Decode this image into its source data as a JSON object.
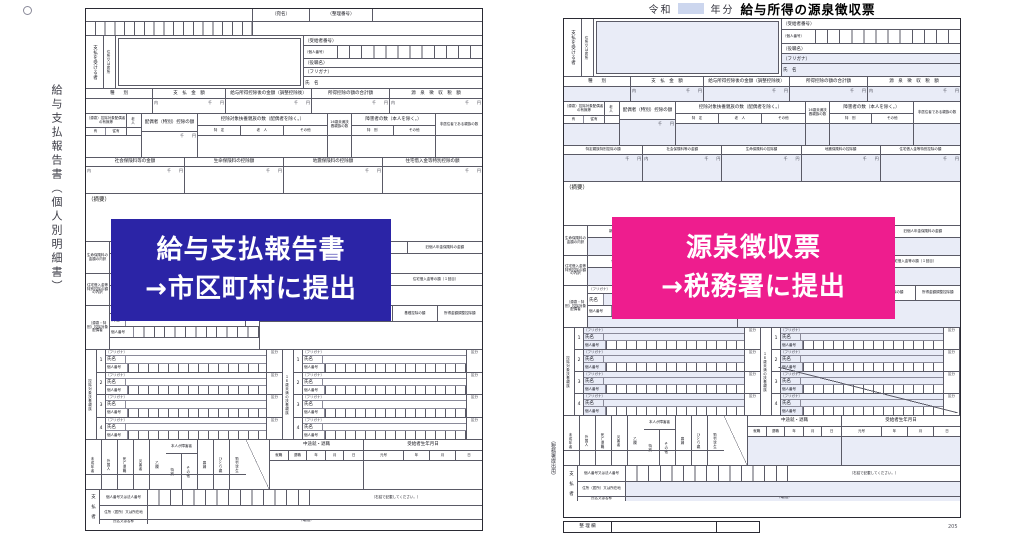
{
  "overlays": {
    "blue": {
      "color": "#2b24a6",
      "line1": "給与支払報告書",
      "line2": "→市区町村に提出"
    },
    "pink": {
      "color": "#ee1d8e",
      "line1": "源泉徴収票",
      "line2": "→税務署に提出"
    }
  },
  "left": {
    "vertical_title": "給与支払報告書（個人別明細書）",
    "top_labels": {
      "c1": "（宛名）",
      "c2": "（整理番号）"
    }
  },
  "right": {
    "title_era": "令和",
    "title_year_suffix": "年分",
    "title_main": "給与所得の源泉徴収票",
    "margin_note": "（税務署提出用）",
    "seiri_label": "整 理 欄",
    "page_no": "205",
    "rowD_cells": [
      "特定親族特別控除の額",
      "社会保険料等の金額",
      "生命保険料の控除額",
      "地震保険料の控除額",
      "住宅借入金等特別控除の額"
    ]
  },
  "common": {
    "recipient": {
      "payer_receiver": "支払を受ける者",
      "address": "住所又は居所",
      "recipient_no": "（受給者番号）",
      "personal_no": "（個人番号）",
      "role": "（役職名）",
      "furigana": "（フリガナ）",
      "name": "氏　名"
    },
    "amounts": {
      "headers": [
        "種　　別",
        "支　払　金　額",
        "給与所得控除後の金額（調整控除後）",
        "所得控除の額の合計額",
        "源　泉　徴　収　税　額"
      ],
      "uchi": "内",
      "senyen": "千　　円"
    },
    "rowC": {
      "spouse": "（源泉）控除対象配偶者の有無等",
      "rojin": "老人",
      "ari": "有",
      "juari": "従有",
      "spouse_ded": "配偶者（特別）控除の額",
      "dep": "控除対象扶養親族の数（配偶者を除く。）",
      "depcols": [
        "特　定",
        "老　人",
        "その他"
      ],
      "u16": "16歳未満扶養親族の数",
      "disabled": "障害者の数（本人を除く。）",
      "discols": [
        "特　別",
        "その他"
      ],
      "nonres": "非居住者である親族の数"
    },
    "rowD": {
      "cells": [
        "社会保険料等の金額",
        "生命保険料の控除額",
        "地震保険料の控除額",
        "住宅借入金等特別控除の額"
      ]
    },
    "tekiyo": "（摘要）",
    "ins": {
      "label": "生命保険料の金額の内訳",
      "cells": [
        "新生命保険料の金額",
        "旧生命保険料の金額",
        "介護医療保険料の金額",
        "新個人年金保険料の金額",
        "旧個人年金保険料の金額"
      ]
    },
    "house": {
      "label": "住宅借入金等特別控除の額の内訳",
      "cells": [
        "住宅借入金等特別控除適用数",
        "居住開始年月日（１回目）",
        "住宅借入金等特別控除区分（１回目）",
        "住宅借入金等の額（１回目）"
      ]
    },
    "spouse2": {
      "label": "（源泉・特別）控除対象配偶者",
      "furigana": "（フリガナ）",
      "name": "氏名",
      "kubun": "区分",
      "kojin": "個人番号",
      "cells": [
        "配偶者の合計所得",
        "国民年金保険料等の金額",
        "旧長期損害保険料の金額",
        "基礎控除の額",
        "所得金額調整控除額"
      ]
    },
    "dep": {
      "label": "控除対象扶養親族",
      "u16label": "１６歳未満の扶養親族",
      "furigana": "（フリガナ）",
      "name": "氏名",
      "kojin": "個人番号",
      "kubun": "区分",
      "nums": [
        "1",
        "2",
        "3",
        "4"
      ]
    },
    "status": {
      "cols": [
        "未成年者",
        "外国人",
        "死亡退職",
        "災害者",
        "乙欄"
      ],
      "honnin": "本人が障害者",
      "discols": [
        "特別",
        "その他"
      ],
      "cols2": [
        "寡婦",
        "ひとり親",
        "勤労学生"
      ],
      "chuto": "中途就・退職",
      "sub": [
        "就職",
        "退職",
        "年",
        "月",
        "日"
      ],
      "birth": "受給者生年月日",
      "bsub": [
        "元号",
        "年",
        "月",
        "日"
      ]
    },
    "payer": {
      "label": "支　払　者",
      "r0": "個人番号又は法人番号",
      "note": "（右詰で記載してください。）",
      "r1": "住所（居所）又は所在地",
      "r2": "氏名又は名称",
      "tel": "（電話）"
    }
  }
}
